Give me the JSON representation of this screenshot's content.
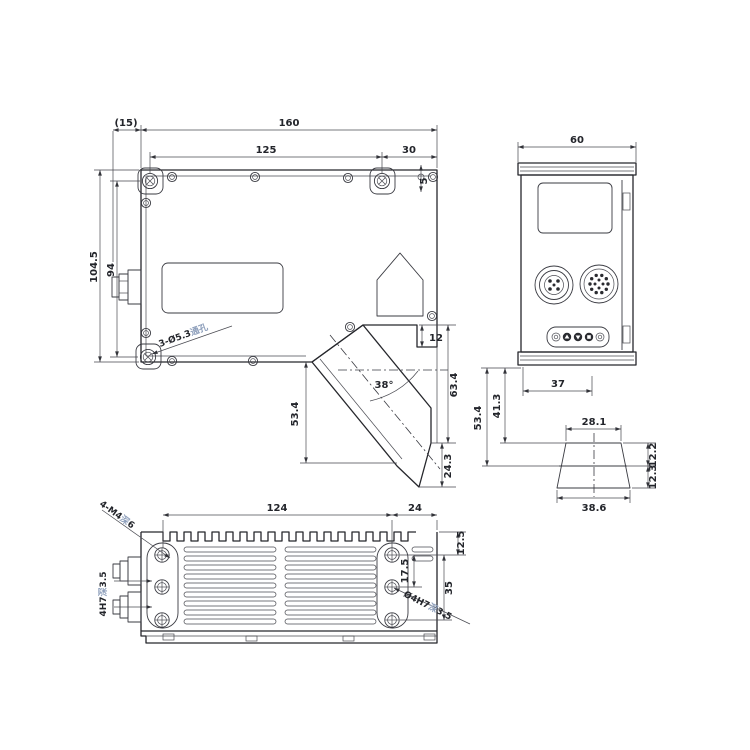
{
  "front_view": {
    "ref_offset": "(15)",
    "total_width": "160",
    "mount_hole_span": "125",
    "right_offset": "30",
    "edge_hole_offset": "5",
    "total_height": "104.5",
    "mount_hole_height": "94",
    "mount_hole_note": {
      "size": "3-Ø5.3",
      "type": "通孔"
    },
    "step_height": "12",
    "right_height": "63.4",
    "tip_height": "24.3",
    "ref_distance": "53.4",
    "beam_angle": "38°"
  },
  "side_view": {
    "width": "60",
    "beam_offset": "37",
    "range_start": "41.3",
    "ref_distance": "53.4",
    "range_near_width": "28.1",
    "range_far_width": "38.6",
    "range_upper": "12.2",
    "range_lower": "12.3"
  },
  "bottom_view": {
    "fin_span": "124",
    "right_offset": "24",
    "edge_hole_offset": "12.5",
    "pin_hole_span": "17.5",
    "mount_hole_span": "35",
    "thread_note": {
      "size": "4-M4",
      "depth_sym": "深",
      "depth": "6"
    },
    "pin_note_left": {
      "size": "4H7",
      "depth_sym": "深",
      "depth": "3.5"
    },
    "pin_note_right": {
      "size": "Ø4H7",
      "depth_sym": "深",
      "depth": "3.5"
    }
  }
}
